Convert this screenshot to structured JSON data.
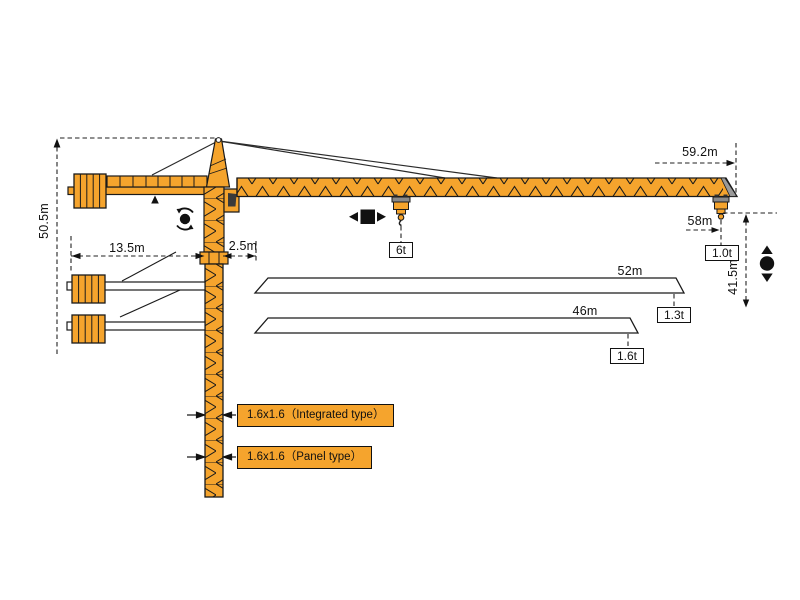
{
  "diagram_kind": "tower-crane-working-range-diagram",
  "dimensions": {
    "overall_height": "50.5m",
    "counter_jib_radius": "13.5m",
    "mast_to_jib_offset": "2.5m",
    "jib_tip_radius": "59.2m",
    "hook_max_radius": "58m",
    "lifting_height": "41.5m"
  },
  "loads": {
    "max_trolley_load": "6t",
    "tip_load": "1.0t"
  },
  "jib_options": [
    {
      "length": "52m",
      "tip_load": "1.3t"
    },
    {
      "length": "46m",
      "tip_load": "1.6t"
    }
  ],
  "mast_sections": [
    {
      "label": "1.6x1.6（Integrated type）"
    },
    {
      "label": "1.6x1.6（Panel type）"
    }
  ],
  "icons": {
    "slewing": "slewing-rotation-icon",
    "trolley_travel": "trolley-travel-icon",
    "hoisting": "hoisting-icon"
  },
  "colors": {
    "crane_orange": "#F5A42D",
    "outline_black": "#1A1A1A",
    "beam_white": "#FFFFFF",
    "window_gray": "#3A3A3A"
  }
}
